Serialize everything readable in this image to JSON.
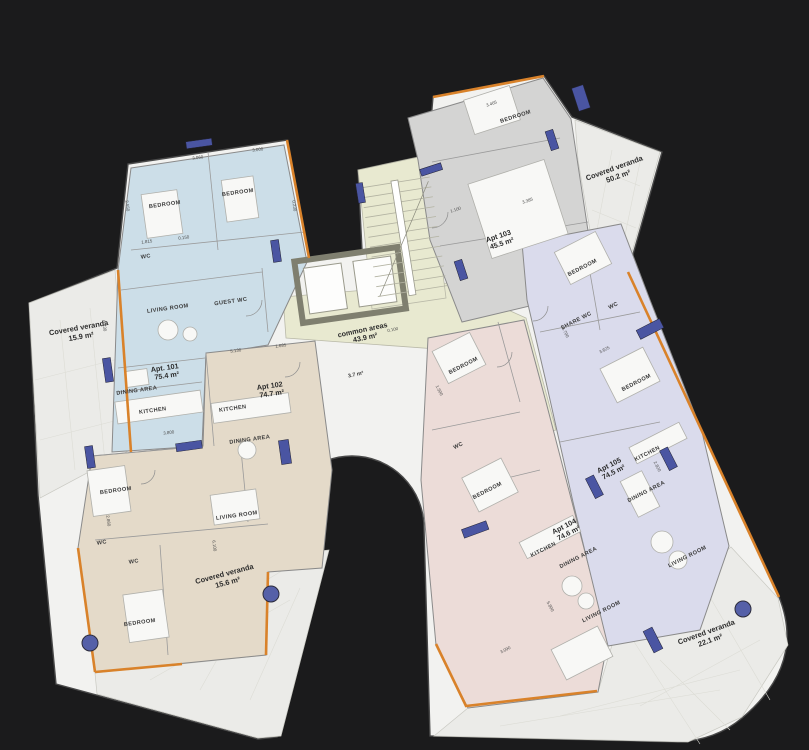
{
  "colors": {
    "background": "#1b1b1c",
    "plate": "#f2f2f0",
    "veranda": "#ebebe8",
    "common": "#e8e9d0",
    "accent_orange": "#d9822a",
    "window_navy": "#4a55a2",
    "column_blue": "#5560a8",
    "elevator_frame": "#7f7f6f"
  },
  "apartments": [
    {
      "id": "apt-101",
      "label": "Apt. 101",
      "area": "75.4 m²",
      "color": "#ccdee8",
      "rooms": [
        "BEDROOM",
        "BEDROOM",
        "WC",
        "GUEST WC",
        "LIVING ROOM",
        "DINING AREA",
        "KITCHEN"
      ]
    },
    {
      "id": "apt-102",
      "label": "Apt 102",
      "area": "74.7 m²",
      "color": "#e4dac9",
      "rooms": [
        "KITCHEN",
        "DINING AREA",
        "BEDROOM",
        "LIVING ROOM",
        "WC",
        "WC",
        "BEDROOM"
      ]
    },
    {
      "id": "apt-103",
      "label": "Apt 103",
      "area": "45.5 m²",
      "color": "#d4d4d3",
      "rooms": [
        "BEDROOM"
      ]
    },
    {
      "id": "apt-104",
      "label": "Apt 104",
      "area": "74.6 m²",
      "color": "#ecdcd8",
      "rooms": [
        "BEDROOM",
        "WC",
        "BEDROOM",
        "KITCHEN",
        "DINING AREA",
        "LIVING ROOM"
      ]
    },
    {
      "id": "apt-105",
      "label": "Apt 105",
      "area": "74.5 m²",
      "color": "#dadbec",
      "rooms": [
        "BEDROOM",
        "SHARE WC",
        "WC",
        "BEDROOM",
        "KITCHEN",
        "DINING AREA",
        "LIVING ROOM"
      ]
    }
  ],
  "common_area": {
    "label": "common areas",
    "area": "43.9 m²",
    "annex": "3.7 m²"
  },
  "verandas": [
    {
      "label": "Covered veranda",
      "area": "15.9 m²"
    },
    {
      "label": "Covered veranda",
      "area": "50.2 m²"
    },
    {
      "label": "Covered veranda",
      "area": "15.6 m²"
    },
    {
      "label": "Covered veranda",
      "area": "22.1 m²"
    }
  ],
  "dimensions": [
    {
      "text": "3.060"
    },
    {
      "text": "3.000"
    },
    {
      "text": "1.815"
    },
    {
      "text": "0.150"
    },
    {
      "text": "2.550"
    },
    {
      "text": "0.230"
    },
    {
      "text": "6.230"
    },
    {
      "text": "5.130"
    },
    {
      "text": "1.685"
    },
    {
      "text": "3.800"
    },
    {
      "text": "6.100"
    },
    {
      "text": "2.860"
    },
    {
      "text": "3.465"
    },
    {
      "text": "1.100"
    },
    {
      "text": "3.385"
    },
    {
      "text": "4.700"
    },
    {
      "text": "3.625"
    },
    {
      "text": "2.820"
    },
    {
      "text": "5.800"
    },
    {
      "text": "1.500"
    },
    {
      "text": "0.100"
    },
    {
      "text": "3.090"
    }
  ]
}
